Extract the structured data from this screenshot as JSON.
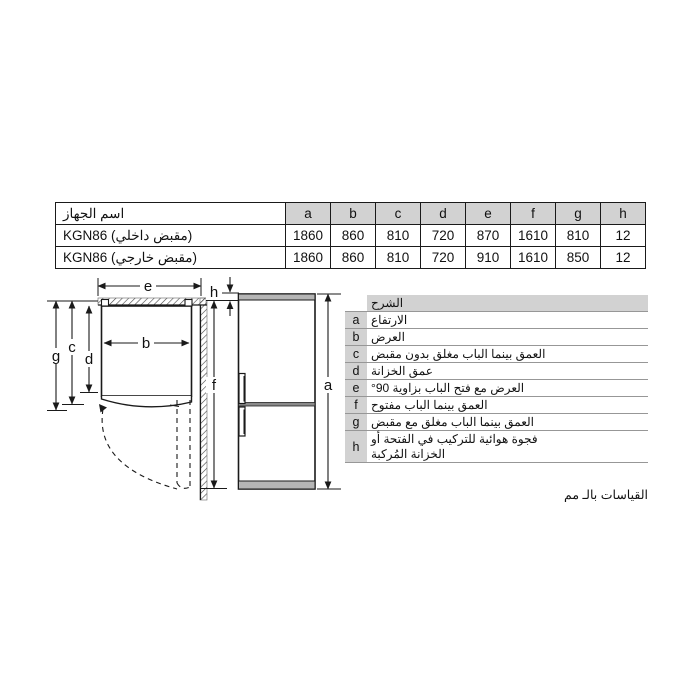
{
  "spec_table": {
    "name_header": "اسم الجهاز",
    "dim_headers": [
      "a",
      "b",
      "c",
      "d",
      "e",
      "f",
      "g",
      "h"
    ],
    "rows": [
      {
        "name": "KGN86 (مقبض داخلي)",
        "values": [
          "1860",
          "860",
          "810",
          "720",
          "870",
          "1610",
          "810",
          "12"
        ]
      },
      {
        "name": "KGN86 (مقبض خارجي)",
        "values": [
          "1860",
          "860",
          "810",
          "720",
          "910",
          "1610",
          "850",
          "12"
        ]
      }
    ]
  },
  "legend": {
    "header": "الشرح",
    "items": [
      {
        "key": "a",
        "text": "الارتفاع"
      },
      {
        "key": "b",
        "text": "العرض"
      },
      {
        "key": "c",
        "text": "العمق بينما الباب مغلق بدون مقبض"
      },
      {
        "key": "d",
        "text": "عمق الخزانة"
      },
      {
        "key": "e",
        "text": "العرض مع فتح الباب بزاوية 90°"
      },
      {
        "key": "f",
        "text": "العمق بينما الباب مفتوح"
      },
      {
        "key": "g",
        "text": "العمق بينما الباب مغلق مع مقبض"
      },
      {
        "key": "h",
        "text": "فجوة هوائية للتركيب في الفتحة أو\nالخزانة المُركبة"
      }
    ]
  },
  "footnote": "القياسات بالـ مم",
  "diagram": {
    "labels": {
      "a": "a",
      "b": "b",
      "c": "c",
      "d": "d",
      "e": "e",
      "f": "f",
      "g": "g",
      "h": "h"
    }
  },
  "colors": {
    "header_gray": "#d2d2d2",
    "band_gray": "#b5b5b5",
    "line": "#1a1a1a"
  }
}
